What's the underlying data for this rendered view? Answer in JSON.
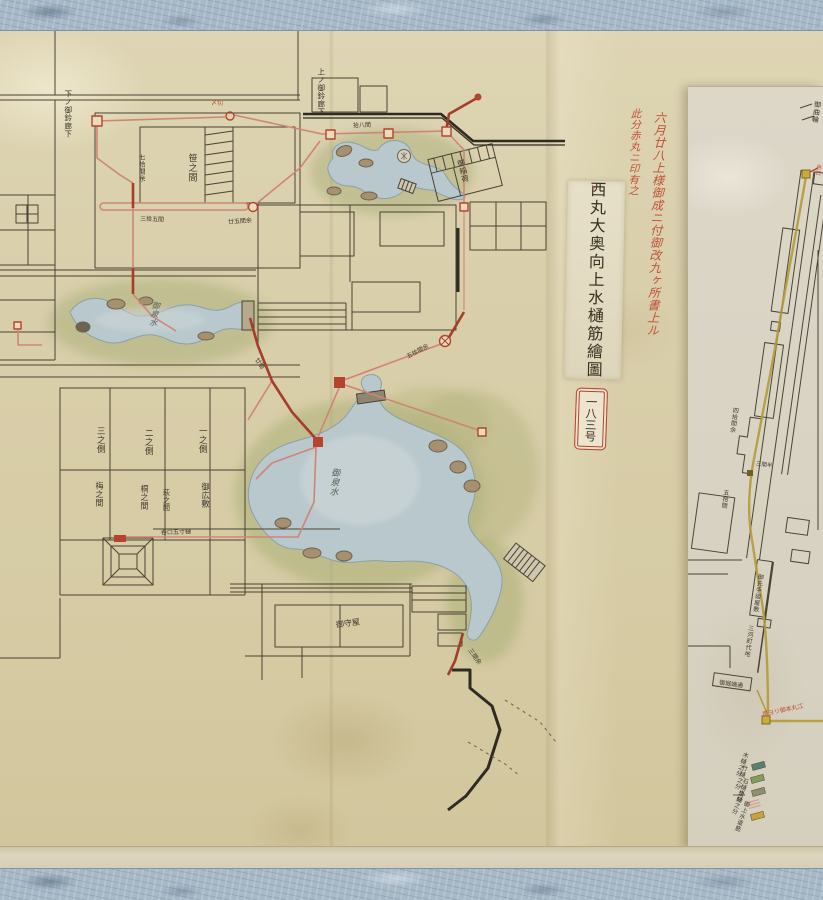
{
  "slips": {
    "title_slip": "西丸大奥向上水樋筋繪圖",
    "number_slip": "一八三号"
  },
  "legend": {
    "entries": [
      {
        "label": "木樋之分",
        "color": "#57806d"
      },
      {
        "label": "竹樋之分",
        "color": "#7f9e5c"
      },
      {
        "label": "石樋之分",
        "color": "#8e9070"
      },
      {
        "label": "掛樋之分",
        "color": "#d79a90"
      },
      {
        "label": "御上水道筋",
        "color": "#c9a23f"
      }
    ]
  },
  "colors": {
    "mount_fabric": "#a7b9c7",
    "paper": "#d9cfab",
    "panel_paper": "#dbd5c6",
    "ink": "#4a4234",
    "pipe_red_dark": "#a63c29",
    "pipe_red_light": "#cf8576",
    "marker_red": "#b5432e",
    "red_text": "#bf4a32",
    "water": "#b9c8cd",
    "shore_green": "#9aa76f",
    "rock": "#a5906f",
    "yellow_pipe": "#b49a3a"
  },
  "map_labels": [
    {
      "name": "red-note-line1",
      "text": "六月廿八上様御成ニ付御改九ヶ所書上ル",
      "x": 656,
      "y": 224,
      "size": 12,
      "color": "#bf4a32",
      "v": true,
      "rot": 2,
      "cls": "cursive"
    },
    {
      "name": "red-note-line2",
      "text": "此分赤丸ニ印有之",
      "x": 634,
      "y": 152,
      "size": 10.5,
      "color": "#bf4a32",
      "v": true,
      "rot": 2,
      "cls": "cursive"
    },
    {
      "name": "corridor-label-top",
      "text": "上ノ御鈴廊下",
      "x": 321,
      "y": 92,
      "size": 7.5,
      "v": true
    },
    {
      "name": "corridor-label-left",
      "text": "下ノ御鈴廊下",
      "x": 68,
      "y": 114,
      "size": 7.5,
      "v": true
    },
    {
      "name": "room-label-sasa",
      "text": "笹之間",
      "x": 191,
      "y": 168,
      "size": 9,
      "v": true
    },
    {
      "name": "shrine-label",
      "text": "御稲荷",
      "x": 463,
      "y": 171,
      "size": 7.5,
      "v": true,
      "rot": -14
    },
    {
      "name": "stream-label",
      "text": "御泉水",
      "x": 154,
      "y": 314,
      "size": 8,
      "color": "#4f5a52",
      "v": true,
      "rot": 8,
      "cls": "cursive"
    },
    {
      "name": "pond-label",
      "text": "御泉水",
      "x": 333,
      "y": 482,
      "size": 9,
      "color": "#4f5a52",
      "v": true,
      "rot": 5,
      "cls": "cursive"
    },
    {
      "name": "room-label-3",
      "text": "三之側",
      "x": 100,
      "y": 440,
      "size": 8.5,
      "v": true
    },
    {
      "name": "room-label-2",
      "text": "二之側",
      "x": 148,
      "y": 442,
      "size": 8.5,
      "v": true
    },
    {
      "name": "room-label-1",
      "text": "一之側",
      "x": 202,
      "y": 440,
      "size": 8.5,
      "v": true
    },
    {
      "name": "room-label-ume",
      "text": "梅之間",
      "x": 99,
      "y": 494,
      "size": 8,
      "v": true
    },
    {
      "name": "room-label-kiri",
      "text": "桐之間",
      "x": 144,
      "y": 497,
      "size": 8,
      "v": true
    },
    {
      "name": "room-label-hagi",
      "text": "萩之間",
      "x": 166,
      "y": 500,
      "size": 7,
      "v": true
    },
    {
      "name": "room-label-hiroshiki",
      "text": "御広敷",
      "x": 205,
      "y": 495,
      "size": 8,
      "v": true
    },
    {
      "name": "room-label-bottom",
      "text": "御守屋",
      "x": 348,
      "y": 624,
      "size": 8,
      "rot": -8
    },
    {
      "name": "pipe-note-tank",
      "text": "呑口五寸樋",
      "x": 176,
      "y": 533,
      "size": 6,
      "rot": -2
    },
    {
      "name": "pipe-note-70ken",
      "text": "七拾間余",
      "x": 141,
      "y": 168,
      "size": 6.5,
      "v": true
    },
    {
      "name": "pipe-note-35ken",
      "text": "三拾五間",
      "x": 152,
      "y": 220,
      "size": 6,
      "rot": 3
    },
    {
      "name": "pipe-note-25ken",
      "text": "廿五間余",
      "x": 240,
      "y": 222,
      "size": 6,
      "rot": -4
    },
    {
      "name": "pipe-note-18ken",
      "text": "拾八間",
      "x": 362,
      "y": 126,
      "size": 6,
      "rot": -2
    },
    {
      "name": "pipe-note-50ken",
      "text": "五拾間余",
      "x": 418,
      "y": 352,
      "size": 6,
      "rot": -28
    },
    {
      "name": "pipe-note-tail",
      "text": "三間余",
      "x": 474,
      "y": 657,
      "size": 6,
      "rot": 55
    },
    {
      "name": "pipe-note-20ken",
      "text": "廿間",
      "x": 259,
      "y": 364,
      "size": 6,
      "rot": 55
    },
    {
      "name": "well-note",
      "text": "〆切",
      "x": 217,
      "y": 104,
      "size": 6,
      "color": "#bf4a32"
    },
    {
      "name": "slip-seal-mark",
      "text": "ゝ",
      "x": 593,
      "y": 188,
      "size": 7,
      "color": "#bf4a32"
    },
    {
      "name": "panel-note-40ken",
      "text": "四拾間余",
      "x": 733,
      "y": 420,
      "size": 6,
      "v": true,
      "rot": 8
    },
    {
      "name": "panel-note-3ken",
      "text": "三間半",
      "x": 764,
      "y": 466,
      "size": 5.5,
      "rot": 8
    },
    {
      "name": "panel-note-50ken",
      "text": "五拾間",
      "x": 724,
      "y": 499,
      "size": 6,
      "v": true,
      "rot": 8
    },
    {
      "name": "panel-label-yashiki",
      "text": "御先手組屋敷",
      "x": 757,
      "y": 593,
      "size": 6,
      "v": true,
      "rot": 8
    },
    {
      "name": "panel-label-machi",
      "text": "三河町代地",
      "x": 748,
      "y": 641,
      "size": 6,
      "v": true,
      "rot": 8
    },
    {
      "name": "panel-label-box",
      "text": "御堀端通",
      "x": 731,
      "y": 685,
      "size": 6,
      "rot": 8
    },
    {
      "name": "panel-note-honmaru",
      "text": "是ヨリ御本丸江",
      "x": 783,
      "y": 711,
      "size": 6,
      "color": "#bf4a32",
      "rot": -12
    },
    {
      "name": "panel-note-nomikuchi",
      "text": "呑口",
      "x": 817,
      "y": 170,
      "size": 5.5,
      "color": "#bf4a32",
      "v": true,
      "rot": 8
    },
    {
      "name": "panel-label-cut",
      "text": "御曲輪",
      "x": 816,
      "y": 112,
      "size": 7,
      "v": true,
      "rot": 8
    },
    {
      "name": "legend-label-1",
      "text": "木樋之分",
      "x": 741,
      "y": 764,
      "size": 6,
      "v": true,
      "rot": 20
    },
    {
      "name": "legend-label-2",
      "text": "竹樋之分",
      "x": 740,
      "y": 777,
      "size": 6,
      "v": true,
      "rot": 20
    },
    {
      "name": "legend-label-3",
      "text": "石樋之分",
      "x": 741,
      "y": 790,
      "size": 6,
      "v": true,
      "rot": 20
    },
    {
      "name": "legend-label-4",
      "text": "掛樋之分",
      "x": 737,
      "y": 802,
      "size": 6,
      "v": true,
      "rot": 20
    },
    {
      "name": "legend-label-5",
      "text": "御上水道筋",
      "x": 741,
      "y": 816,
      "size": 6,
      "v": true,
      "rot": 20
    }
  ]
}
